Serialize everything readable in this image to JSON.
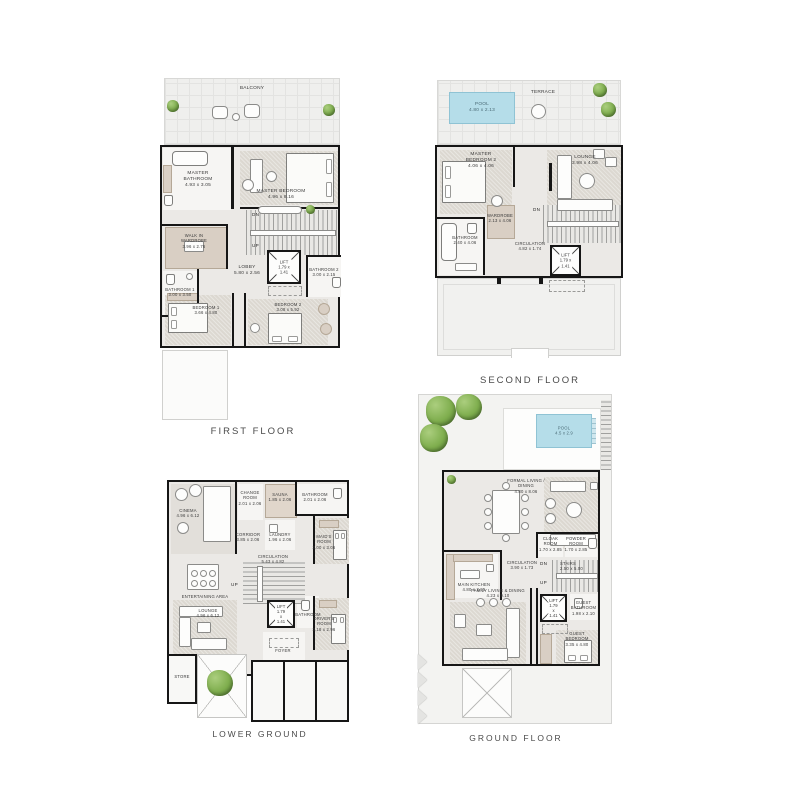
{
  "titles": {
    "first": "FIRST FLOOR",
    "second": "SECOND FLOOR",
    "lower": "LOWER GROUND",
    "ground": "GROUND FLOOR"
  },
  "colors": {
    "wall": "#161616",
    "pool": "#b5dde9",
    "tree": "#7fae4e",
    "carpet": "#dcd8d1",
    "floor": "#ebe9e6",
    "title_text": "#4a4a4a"
  },
  "first": {
    "balcony": "BALCONY",
    "master_bathroom": "MASTER\nBATHROOM\n4.93 x 3.05",
    "master_bedroom": "MASTER BEDROOM\n4.96 x 8.16",
    "wardrobe": "WALK IN\nWARDROBE\n3.96 x 2.76",
    "lobby": "LOBBY\n5.80 x 2.56",
    "lift": "LIFT\n1.79 x 1.41",
    "bathroom1": "BATHROOM 1\n3.00 x 3.50",
    "bathroom2": "BATHROOM 2\n3.00 x 2.15",
    "bedroom1": "BEDROOM 1\n3.66 x 4.80",
    "bedroom2": "BEDROOM 2\n3.08 x 5.92",
    "dn": "DN",
    "up": "UP"
  },
  "second": {
    "pool": "POOL\n4.80 x 2.13",
    "terrace": "TERRACE",
    "master_bedroom2": "MASTER\nBEDROOM 2\n4.06 x 4.06",
    "lounge": "LOUNGE\n3.98 x 4.06",
    "wardrobe": "WARDROBE\n2.13 x 4.06",
    "bathroom": "BATHROOM\n2.40 x 4.06",
    "circulation": "CIRCULATION\n4.82 x 1.74",
    "lift": "LIFT\n1.79 x 1.41",
    "dn": "DN"
  },
  "lower": {
    "cinema": "CINEMA\n4.96 x 6.12",
    "change_room": "CHANGE\nROOM\n2.01 x 2.06",
    "sauna": "SAUNA\n1.85 x 2.06",
    "bathroom_top": "BATHROOM\n2.01 x 2.06",
    "laundry": "LAUNDRY\n1.96 x 2.06",
    "corridor": "CORRIDOR\n3.85 x 2.06",
    "maids_room": "MAID'S ROOM\n3.00 x 3.06",
    "circulation": "CIRCULATION\n5.43 x 4.82",
    "entertaining": "ENTERTAINING AREA",
    "lounge": "LOUNGE\n4.96 x 6.12",
    "lift": "LIFT\n1.79 x 1.41",
    "bathroom": "BATHROOM",
    "foyer": "FOYER",
    "drivers_room": "DRIVER'S\nROOM\n3.18 x 2.96",
    "store": "STORE",
    "up": "UP"
  },
  "ground": {
    "pool": "POOL\n4.5 x 2.9",
    "formal_living": "FORMAL LIVING /\nDINING\n4.80 x 8.06",
    "main_kitchen": "MAIN KITCHEN\n4.80 x 3.95",
    "circulation": "CIRCULATION\n3.90 x 1.73",
    "cloak_room": "CLOAK\nROOM\n1.70 x 2.85",
    "powder_room": "POWDER\nROOM\n1.70 x 2.85",
    "stairs": "STAIRS\n2.50 x 5.00",
    "family_living": "FAMILY LIVING & DINING\n4.23 x 9.10",
    "lift": "LIFT\n1.79 x 1.41",
    "guest_bathroom": "GUEST\nBATHROOM\n1.98 x 2.10",
    "guest_bedroom": "GUEST\nBEDROOM\n3.35 x 4.80",
    "dn": "DN",
    "up": "UP"
  }
}
